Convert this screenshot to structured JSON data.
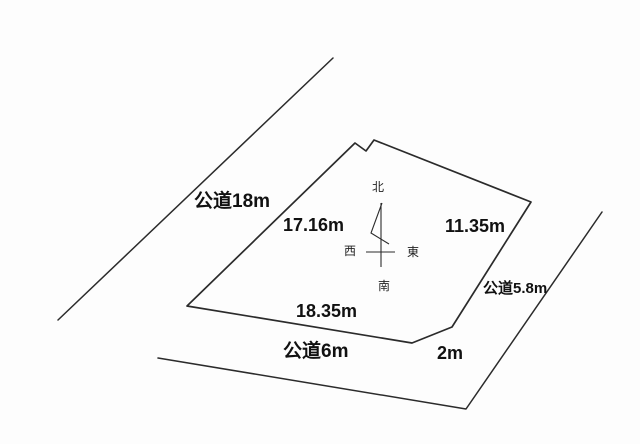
{
  "colors": {
    "line": "#2b2b2b",
    "text": "#111111",
    "background": "#fdfdfd"
  },
  "roads": {
    "west": {
      "label": "公道18m"
    },
    "south": {
      "label": "公道6m"
    },
    "east": {
      "label": "公道5.8m"
    }
  },
  "plot": {
    "edges": {
      "northwest": "17.16m",
      "northeast": "11.35m",
      "south": "18.35m",
      "southeast_cut": "2m"
    }
  },
  "compass": {
    "north": "北",
    "south": "南",
    "east": "東",
    "west": "西"
  }
}
